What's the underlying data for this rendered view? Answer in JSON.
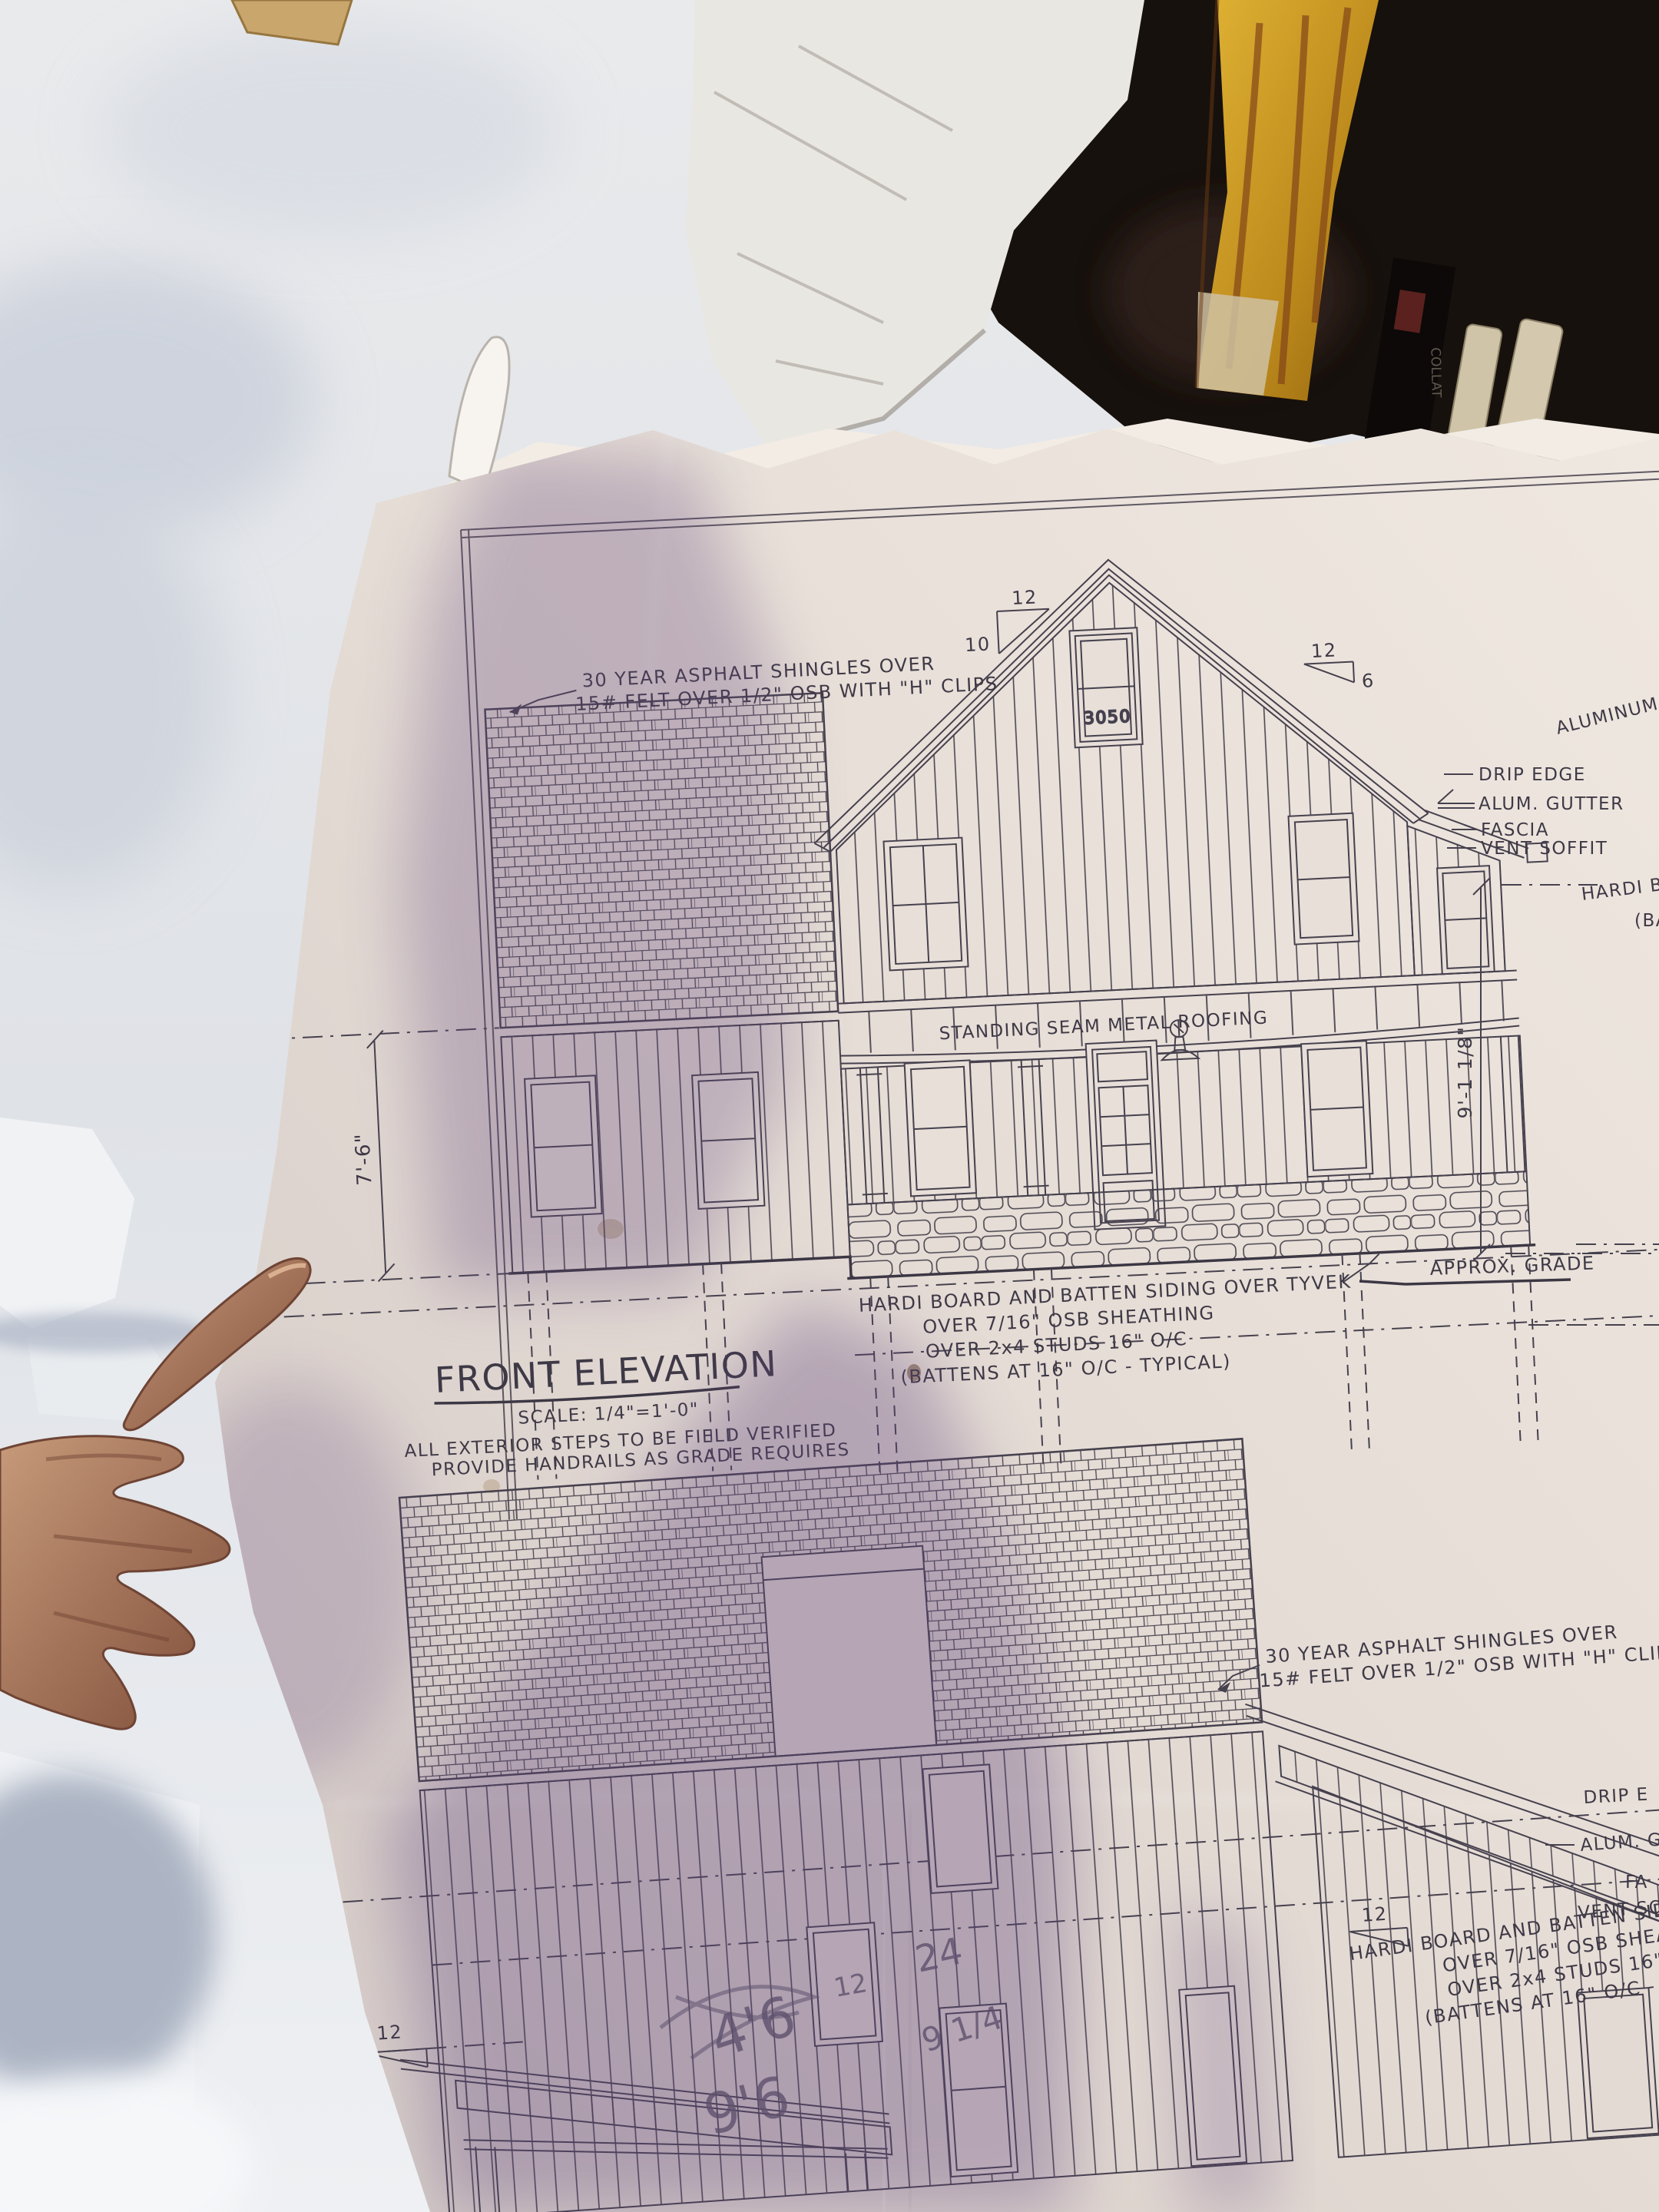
{
  "background": {
    "box_label": "COLLAT"
  },
  "upper": {
    "roof_note1": "30 YEAR ASPHALT SHINGLES OVER",
    "roof_note2": "15# FELT OVER 1/2\" OSB WITH \"H\" CLIPS",
    "pitch_main_rise": "12",
    "pitch_main_run": "10",
    "pitch_porch_rise": "12",
    "pitch_porch_run": "6",
    "window_label": "3050",
    "aluminum_wrap": "ALUMINUM WRAP",
    "drip_edge": "DRIP EDGE",
    "alum_gutter": "ALUM. GUTTER",
    "fascia": "FASCIA",
    "vent_soffit": "VENT SOFFIT",
    "hardi_cut1": "HARDI BOA",
    "hardi_cut2": "(BA",
    "standing_seam": "STANDING SEAM METAL ROOFING",
    "siding1": "HARDI BOARD AND BATTEN SIDING OVER TYVEK",
    "siding2": "OVER 7/16\" OSB SHEATHING",
    "siding3": "OVER 2x4 STUDS 16\" O/C",
    "siding4": "(BATTENS AT 16\" O/C - TYPICAL)",
    "grade": "APPROX. GRADE",
    "dim_left": "7'-6\"",
    "dim_right": "9'-1 1/8\"",
    "title": "FRONT ELEVATION",
    "scale_label": "SCALE: 1/4\"=1'-0\"",
    "steps1": "ALL EXTERIOR STEPS TO BE FIELD VERIFIED",
    "steps2": "PROVIDE HANDRAILS AS GRADE REQUIRES"
  },
  "lower": {
    "roof_note1": "30 YEAR ASPHALT SHINGLES OVER",
    "roof_note2": "15# FELT OVER 1/2\" OSB WITH \"H\" CLIPS",
    "drip_cut": "DRIP E",
    "gutter_cut": "ALUM. GU",
    "fascia_cut": "FA",
    "soffit_cut": "VENT SO",
    "siding1": "HARDI BOARD AND BATTEN SIDING OVER",
    "siding2": "OVER 7/16\" OSB SHEATHING",
    "siding3": "OVER 2x4 STUDS 16\" O/C",
    "siding4": "(BATTENS AT 16\" O/C - TYPICAL)",
    "pitch_left_run": "3.5",
    "pitch_left_rise": "12",
    "pitch_right_rise": "12",
    "pencil_46": "4'6",
    "pencil_96": "9'6",
    "pencil_24": "24",
    "pencil_12": "12",
    "pencil_914": "9 1/4"
  }
}
